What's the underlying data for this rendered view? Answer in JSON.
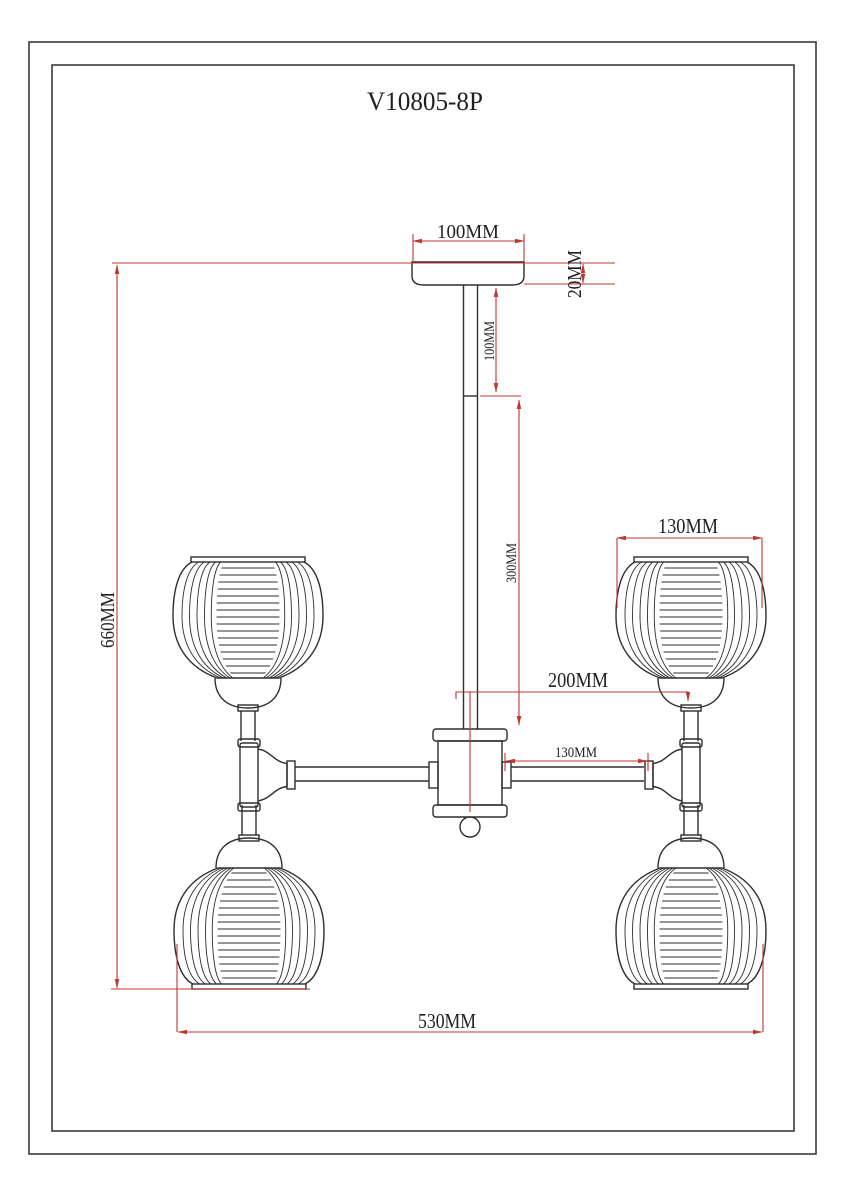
{
  "title": "V10805-8P",
  "units": "MM",
  "dimensions": {
    "canopy_width": "100MM",
    "canopy_height": "20MM",
    "rod_upper_section": "100MM",
    "rod_lower_section": "300MM",
    "center_to_lamp_axis": "200MM",
    "arm_segment": "130MM",
    "shade_diameter": "130MM",
    "overall_height": "660MM",
    "overall_width": "530MM"
  },
  "colors": {
    "drawing_lines": "#2e2e2e",
    "dimension_lines": "#bf3732",
    "background": "#ffffff"
  }
}
